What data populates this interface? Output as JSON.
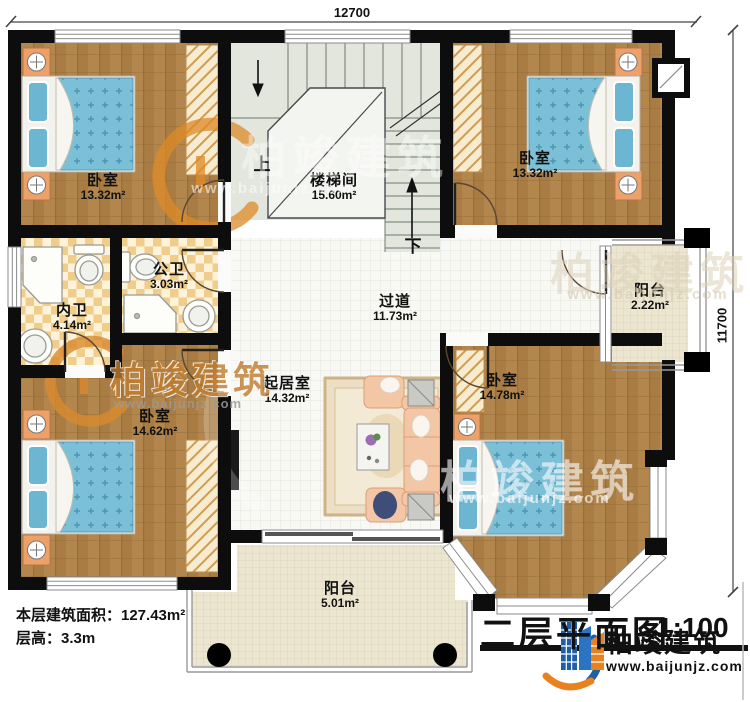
{
  "dimensions": {
    "width_label": "12700",
    "height_label": "11700"
  },
  "stairs": {
    "room": "楼梯间",
    "area": "15.60m²",
    "up": "上",
    "down": "下"
  },
  "rooms": {
    "bedroom_top_left": {
      "name": "卧室",
      "area": "13.32m²"
    },
    "bedroom_top_right": {
      "name": "卧室",
      "area": "13.32m²"
    },
    "bedroom_bottom_left": {
      "name": "卧室",
      "area": "14.62m²"
    },
    "bedroom_bottom_right": {
      "name": "卧室",
      "area": "14.78m²"
    },
    "bath_private": {
      "name": "内卫",
      "area": "4.14m²"
    },
    "bath_shared": {
      "name": "公卫",
      "area": "3.03m²"
    },
    "corridor": {
      "name": "过道",
      "area": "11.73m²"
    },
    "living": {
      "name": "起居室",
      "area": "14.32m²"
    },
    "balcony_side": {
      "name": "阳台",
      "area": "2.22m²"
    },
    "balcony_front": {
      "name": "阳台",
      "area": "5.01m²"
    }
  },
  "info": {
    "floor_area": "本层建筑面积：127.43m²",
    "story_height": "层高：3.3m"
  },
  "title": {
    "name": "二层平面图",
    "scale": "1:100"
  },
  "brand": {
    "name": "柏竣建筑",
    "website": "www.baijunjz.com"
  }
}
